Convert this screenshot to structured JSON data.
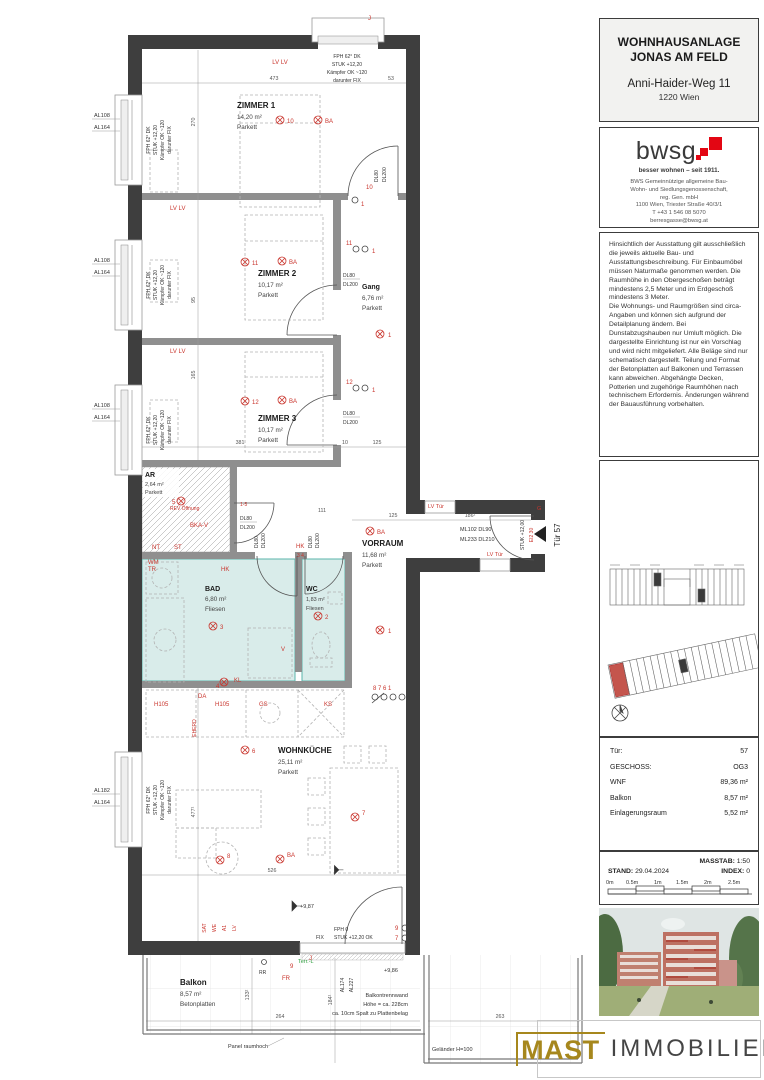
{
  "plan": {
    "rooms": [
      {
        "name": "ZIMMER 1",
        "area": "14,20 m²",
        "floor": "Parkett"
      },
      {
        "name": "ZIMMER 2",
        "area": "10,17 m²",
        "floor": "Parkett"
      },
      {
        "name": "ZIMMER 3",
        "area": "10,17 m²",
        "floor": "Parkett"
      },
      {
        "name": "Gang",
        "area": "6,76 m²",
        "floor": "Parkett"
      },
      {
        "name": "AR",
        "area": "2,64 m²",
        "floor": "Parkett"
      },
      {
        "name": "VORRAUM",
        "area": "11,68 m²",
        "floor": "Parkett"
      },
      {
        "name": "BAD",
        "area": "6,80 m²",
        "floor": "Fliesen"
      },
      {
        "name": "WC",
        "area": "1,83 m²",
        "floor": "Fliesen"
      },
      {
        "name": "WOHNKÜCHE",
        "area": "25,11 m²",
        "floor": "Parkett"
      },
      {
        "name": "Balkon",
        "area": "8,57 m²",
        "floor": "Betonplatten"
      }
    ],
    "labels": {
      "lvlv": "LV LV",
      "lvtuer": "LV Tür",
      "fph1": "FPH 62°  DK",
      "fph2": "STUK +12,20",
      "fph3": "Kämpfer OK ~120",
      "fph4": "darunter FIX",
      "fph0": "FPH 0",
      "stukok": "STUK +12,20  OK",
      "fix": "FIX",
      "stuk1200": "STUK +12,00",
      "al108": "AL108",
      "al164": "AL164",
      "al182": "AL182",
      "al174": "AL174",
      "al227": "AL227",
      "dl80": "DL80",
      "dl200": "DL200",
      "ml1": "ML102  DL90",
      "ml2": "ML233  DL210",
      "ei230": "EI2 30",
      "tuer57": "Tür 57",
      "g": "G",
      "j": "J",
      "rev": "REV Öffnung",
      "bkav": "BKA-V",
      "nt": "NT",
      "st": "ST",
      "wm": "WM",
      "tr": "TR",
      "hk": "HK",
      "kl": "KL",
      "da": "DA",
      "v": "V",
      "h105": "H105",
      "gs": "GS",
      "ks": "KS",
      "eherd": "EHERD",
      "sat": "SAT",
      "we": "WE",
      "a1": "A1",
      "lv": "LV",
      "fr": "FR",
      "rr": "RR",
      "terrl": "Terr.-L",
      "ba": "BA",
      "lvl987": "+9,87",
      "lvl986": "+9,86",
      "trenn1": "Balkontrennwand",
      "trenn2": "Höhe = ca. 228cm",
      "trenn3": "ca. 10cm Spalt zu Plattenbelag",
      "panel": "Panel raumhoch",
      "gelaender": "Geländer H=100",
      "n1": "1",
      "n2": "2",
      "n3": "3",
      "n4": "4",
      "n5": "5",
      "n6": "6",
      "n7": "7",
      "n8": "8",
      "n9": "9",
      "n10": "10",
      "n11": "11",
      "n12": "12",
      "n8761": "8 7 6 1",
      "n34": "3 4",
      "n15": "1-5"
    },
    "dims": {
      "d473": "473",
      "d270": "270",
      "d53": "53",
      "d381": "381",
      "d125": "125",
      "d10": "10",
      "d186": "186¹",
      "d526": "526",
      "d477": "477¹",
      "d264": "264",
      "d263": "263",
      "d133": "133²",
      "d184": "184¹",
      "d111": "111",
      "d165": "165",
      "d95": "95"
    }
  },
  "tb": {
    "header": {
      "l1": "WOHNHAUSANLAGE",
      "l2": "JONAS AM FELD",
      "l3": "Anni-Haider-Weg 11",
      "l4": "1220 Wien"
    },
    "bwsg": {
      "logo": "bwsg",
      "tagline": "besser wohnen – seit 1911.",
      "c1": "BWS Gemeinnützige allgemeine Bau-",
      "c2": "Wohn- und Siedlungsgenossenschaft,",
      "c3": "reg. Gen. mbH",
      "c4": "1100 Wien, Triester Straße 40/3/1",
      "c5": "T +43 1 546 08 5070",
      "c6": "berresgasse@bwsg.at",
      "red": "#e30613"
    },
    "disc1": "Hinsichtlich der Ausstattung gilt ausschließlich die jeweils aktuelle Bau- und Ausstattungsbeschreibung. Für Einbaumöbel müssen Naturmaße genommen werden. Die Raumhöhe in den Obergeschoßen beträgt mindestens 2,5 Meter und im Erdgeschoß mindestens 3 Meter.",
    "disc2": "Die Wohnungs- und Raumgrößen sind circa-Angaben und können sich aufgrund der Detailplanung ändern. Bei Dunstabzugshauben nur Umluft möglich. Die dargestellte Einrichtung ist nur ein Vorschlag und wird nicht mitgeliefert. Alle Beläge sind nur schematisch dargestellt. Teilung und Format der Betonplatten auf Balkonen und Terrassen kann abweichen. Abgehängte Decken, Potterien und zugehörige Raumhöhen nach technischem Erfordernis. Änderungen während der Bauausführung vorbehalten.",
    "rows": [
      {
        "label": "Tür:",
        "value": "57"
      },
      {
        "label": "GESCHOSS:",
        "value": "OG3"
      },
      {
        "label": "WNF",
        "value": "89,36 m²"
      },
      {
        "label": "Balkon",
        "value": "8,57 m²"
      },
      {
        "label": "Einlagerungsraum",
        "value": "5,52 m²"
      }
    ],
    "meta": {
      "ml": "MASSTAB:",
      "mv": "1:50",
      "sl": "STAND:",
      "sv": "29.04.2024",
      "il": "INDEX:",
      "iv": "0"
    },
    "scale": [
      "0m",
      "0.5m",
      "1m",
      "1.5m",
      "2m",
      "2.5m"
    ],
    "logo": {
      "p1": "MAST",
      "p2": "IMMOBILIEN",
      "gold": "#a6871d"
    }
  }
}
